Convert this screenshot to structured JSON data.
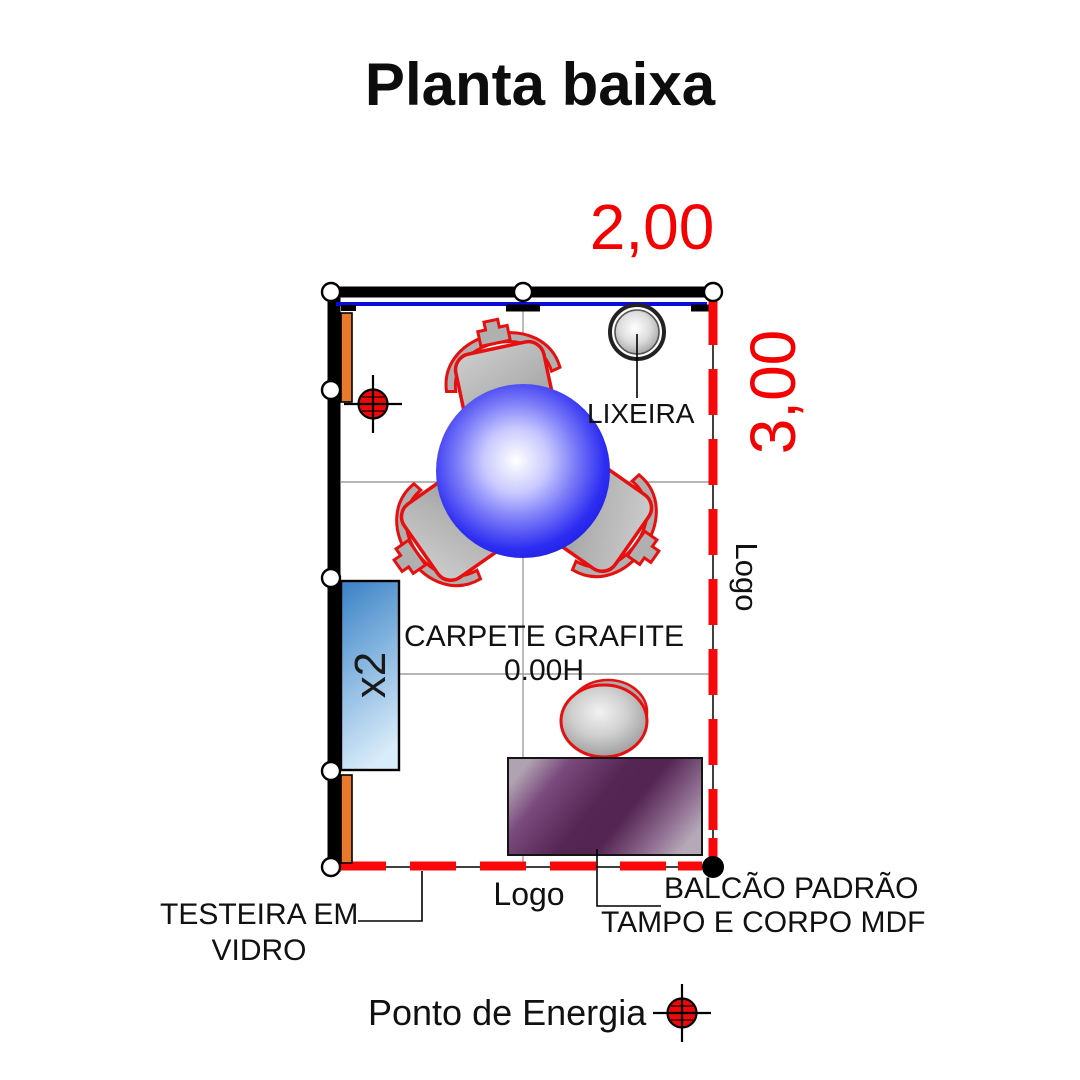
{
  "title": "Planta baixa",
  "dimensions": {
    "width_label": "2,00",
    "height_label": "3,00"
  },
  "plan": {
    "carpet_label": "CARPETE GRAFITE",
    "carpet_height_label": "0.00H",
    "trash_label": "LIXEIRA",
    "cabinet_count_label": "x2",
    "logo_side_label": "Logo",
    "logo_bottom_label": "Logo"
  },
  "annotations": {
    "testeira_line1": "TESTEIRA EM",
    "testeira_line2": "VIDRO",
    "balcao_line1": "BALCÃO PADRÃO",
    "balcao_line2": "TAMPO E CORPO MDF"
  },
  "legend": {
    "energy_point_label": "Ponto de Energia"
  },
  "colors": {
    "dimension_red": "#f50000",
    "dash_red": "#f80808",
    "glass_blue": "#0b0bdb",
    "table_blue": "#2a2af0",
    "cabinet_blue": "#4f93d0",
    "counter_purple": "#552553",
    "shelf_orange": "#e8782a",
    "power_red": "#ee0808",
    "chair_outline_red": "#e61010",
    "wall_black": "#000000"
  }
}
